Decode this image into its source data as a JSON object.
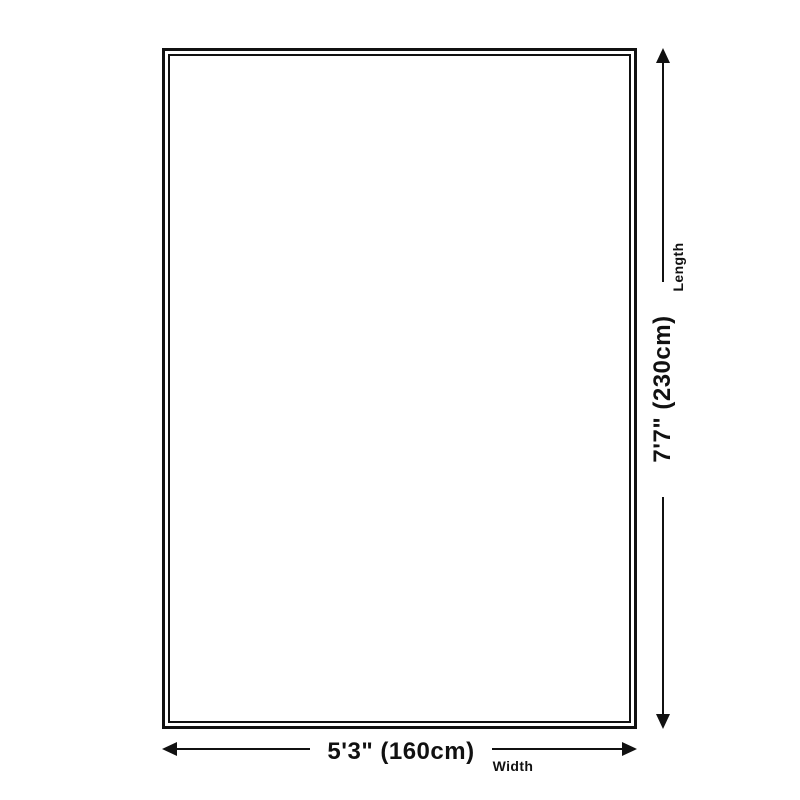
{
  "diagram": {
    "dimensions": {
      "length": {
        "label": "Length",
        "value": "7'7\" (230cm)"
      },
      "width": {
        "label": "Width",
        "value": "5'3\" (160cm)"
      }
    },
    "icons": {
      "length_arrow": "double-headed-vertical-arrow",
      "width_arrow": "double-headed-horizontal-arrow"
    },
    "colors": {
      "line": "#111111",
      "background": "#ffffff"
    }
  }
}
